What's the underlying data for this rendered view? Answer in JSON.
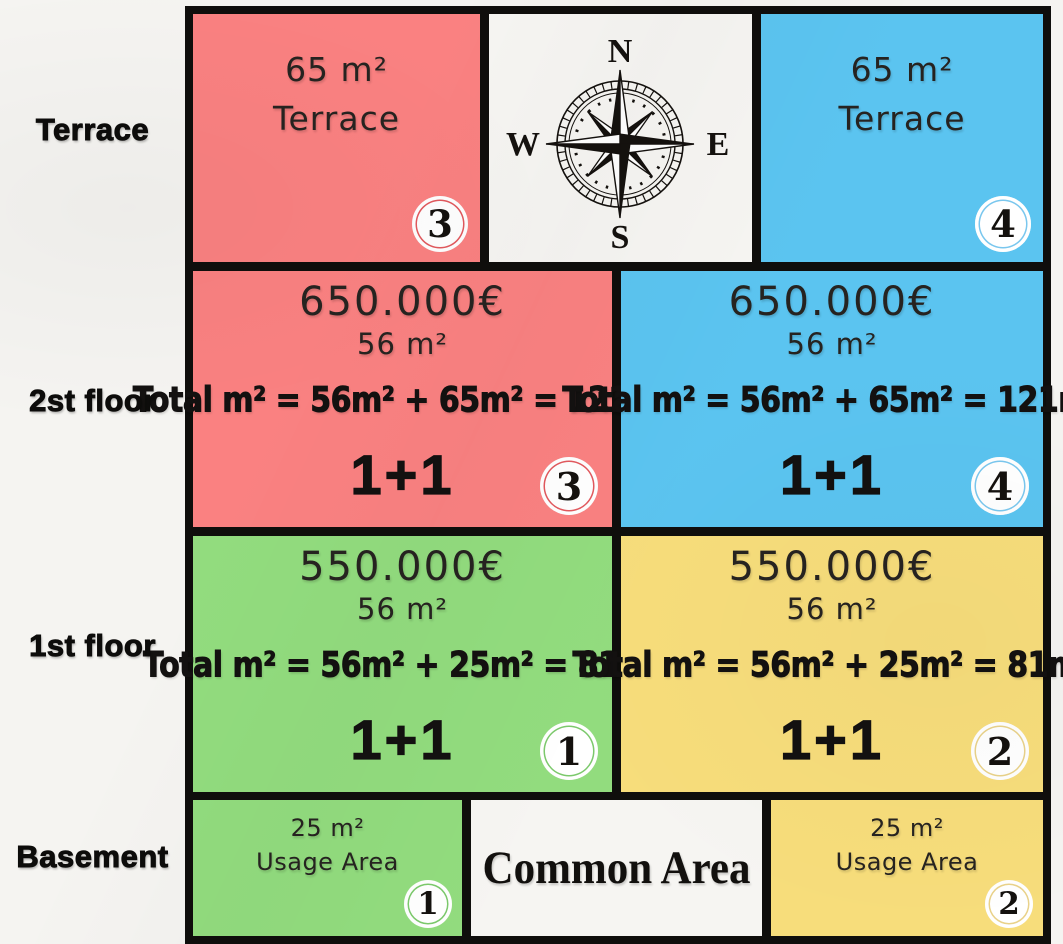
{
  "colors": {
    "red": "#fa8181",
    "blue": "#5bc4f0",
    "green": "#92dc7e",
    "yellow": "#f7dd7b",
    "border_black": "#0f0e0c",
    "background": "#f5f4f1",
    "badge_ring_red": "#e2595e",
    "badge_ring_blue": "#7ac7ee",
    "badge_ring_green": "#7cc96c",
    "badge_ring_yellow": "#e9d28a"
  },
  "row_labels": {
    "terrace": "Terrace",
    "second_floor": "2st floor",
    "first_floor": "1st floor",
    "basement": "Basement"
  },
  "compass": {
    "n": "N",
    "e": "E",
    "s": "S",
    "w": "W"
  },
  "units": {
    "terrace_left": {
      "area": "65 m²",
      "name": "Terrace",
      "badge": "3"
    },
    "terrace_right": {
      "area": "65 m²",
      "name": "Terrace",
      "badge": "4"
    },
    "floor2_left": {
      "price": "650.000€",
      "area": "56 m²",
      "total": "Total m² = 56m² + 65m² = 121m²",
      "layout": "1+1",
      "badge": "3"
    },
    "floor2_right": {
      "price": "650.000€",
      "area": "56 m²",
      "total": "Total m² = 56m² + 65m² = 121m²",
      "layout": "1+1",
      "badge": "4"
    },
    "floor1_left": {
      "price": "550.000€",
      "area": "56 m²",
      "total": "Total m² = 56m² + 25m² = 81m²",
      "layout": "1+1",
      "badge": "1"
    },
    "floor1_right": {
      "price": "550.000€",
      "area": "56 m²",
      "total": "Total m² = 56m² + 25m² = 81m²",
      "layout": "1+1",
      "badge": "2"
    },
    "basement_left": {
      "area": "25 m²",
      "name": "Usage Area",
      "badge": "1"
    },
    "basement_right": {
      "area": "25 m²",
      "name": "Usage Area",
      "badge": "2"
    },
    "common": {
      "name": "Common Area"
    }
  }
}
